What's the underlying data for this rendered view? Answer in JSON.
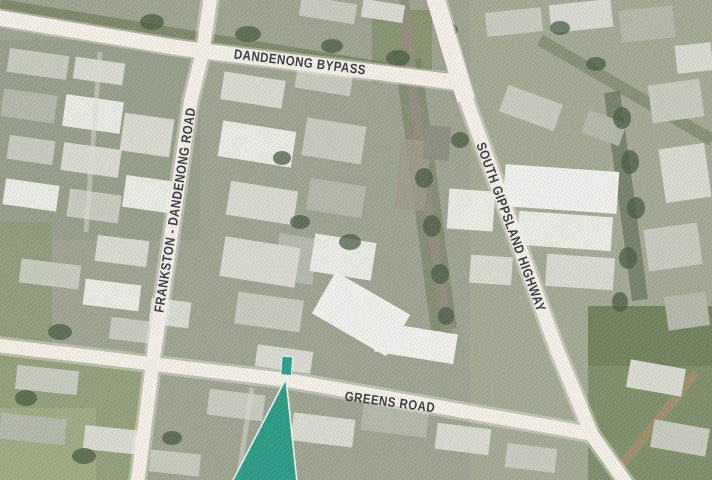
{
  "map": {
    "view_type": "satellite",
    "roads": [
      {
        "id": "dandenong-bypass",
        "label": "DANDENONG BYPASS"
      },
      {
        "id": "frankston-dandenong-road",
        "label": "FRANKSTON - DANDENONG ROAD"
      },
      {
        "id": "south-gippsland-highway",
        "label": "SOUTH GIPPSLAND HIGHWAY"
      },
      {
        "id": "greens-road",
        "label": "GREENS ROAD"
      }
    ],
    "marker": {
      "name": "property-location-marker",
      "shape": "teal wedge pin with highlighted parcel",
      "color": "#1e9c85"
    },
    "colors": {
      "road_fill": "#f4f1e9",
      "road_label_text": "#3b3f43",
      "marker_teal": "#1e9c85"
    }
  }
}
